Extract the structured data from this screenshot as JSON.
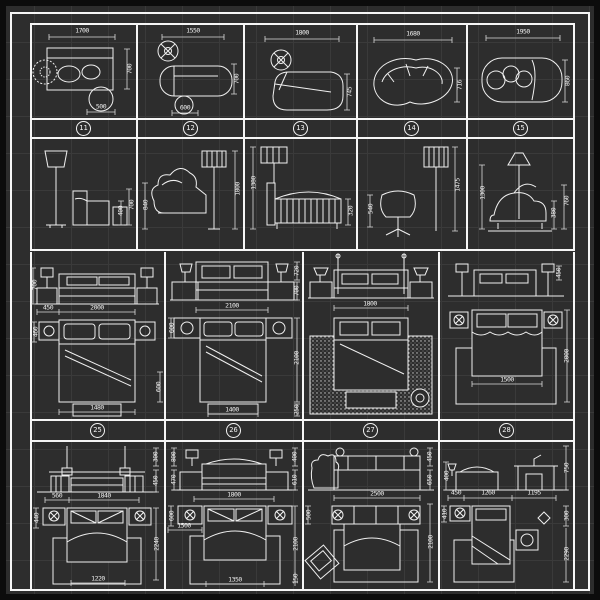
{
  "badges": {
    "top": [
      "11",
      "12",
      "13",
      "14",
      "15"
    ],
    "bottom": [
      "25",
      "26",
      "27",
      "28"
    ]
  },
  "cells": {
    "r1c1": {
      "top": "1700",
      "right": "700",
      "bottom": "500"
    },
    "r1c2": {
      "top": "1550",
      "right": "700",
      "bottom": "600"
    },
    "r1c3": {
      "top": "1800",
      "right": "745"
    },
    "r1c4": {
      "top": "1680",
      "right": "716"
    },
    "r1c5": {
      "top": "1950",
      "right": "860"
    },
    "r2c1": {
      "height_total": "700",
      "height_seat": "400"
    },
    "r2c2": {
      "chair_height": "840",
      "lamp_height": "1800"
    },
    "r2c3": {
      "height": "1380",
      "depth": "320"
    },
    "r2c4": {
      "chair_height": "540",
      "lamp_height": "1475"
    },
    "r2c5": {
      "height": "1300",
      "seat_height": "380",
      "back_height": "760"
    },
    "r3c1": {
      "elev_height": "700",
      "nightstand_w": "450",
      "bed_w": "2000",
      "side": "460",
      "bottom": "1480",
      "bench": "600"
    },
    "r3c2": {
      "lamp_h": "720",
      "elev_h": "700",
      "bed_w": "2100",
      "nightstand": "600",
      "bed_len": "2100",
      "bench": "250",
      "bottom": "1400"
    },
    "r3c3": {
      "bed_w": "1800"
    },
    "r3c4": {
      "elev": "450",
      "bed_len": "2000",
      "bed_w": "1500"
    },
    "r4c1": {
      "lamp": "300",
      "elev": "450",
      "nightstand": "560",
      "bed_w": "1840",
      "side": "440",
      "bed_len": "2240",
      "bottom": "1220"
    },
    "r4c2": {
      "lamp_h": "800",
      "elev_h": "470",
      "wall_lamp": "400",
      "headboard": "610",
      "bed_w": "1800",
      "nightstand": "600",
      "left_w": "1500",
      "bed_len": "2100",
      "edge": "150",
      "bottom": "1350"
    },
    "r4c3": {
      "width": "2500",
      "seat": "450",
      "back": "650",
      "side": "500",
      "bed_len": "2100"
    },
    "r4c4": {
      "lamp": "400",
      "s1": "450",
      "s2": "1260",
      "s3": "1195",
      "height": "750",
      "side": "410",
      "gap": "300",
      "bed_len": "2290"
    }
  }
}
